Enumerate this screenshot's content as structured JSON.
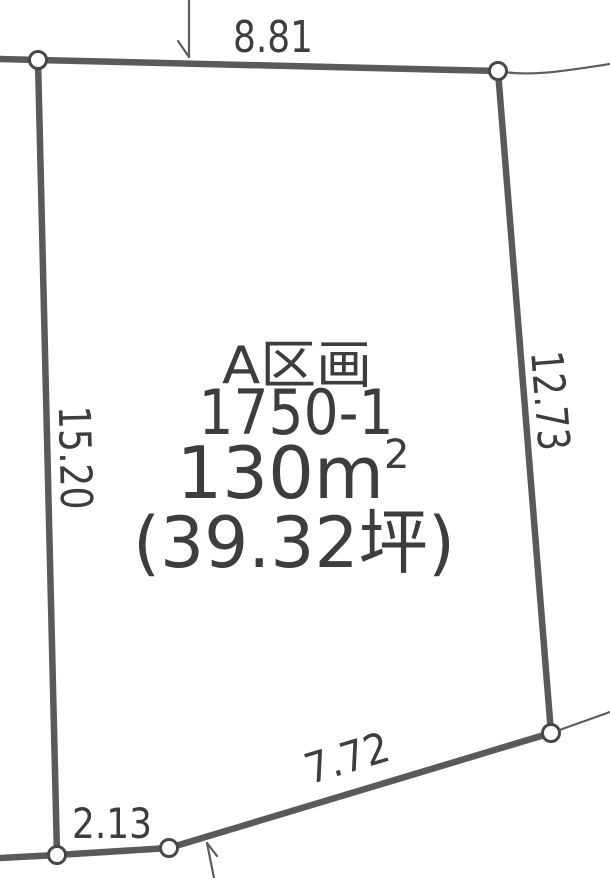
{
  "diagram": {
    "parcel": {
      "section": "A区画",
      "lot_number": "1750-1",
      "area_m2_base": "130m",
      "area_m2_sup": "2",
      "area_tsubo": "(39.32坪)"
    },
    "dimensions": {
      "top_edge": "8.81",
      "left_edge": "15.20",
      "right_edge": "12.73",
      "bottom_diagonal_edge": "7.72",
      "bottom_left_edge": "2.13"
    },
    "colors": {
      "boundary_line": "#5a5a5a",
      "thin_line": "#5d5d5d",
      "vertex_stroke": "#474747",
      "text": "#3d3d3d",
      "background": "#ffffff"
    }
  }
}
